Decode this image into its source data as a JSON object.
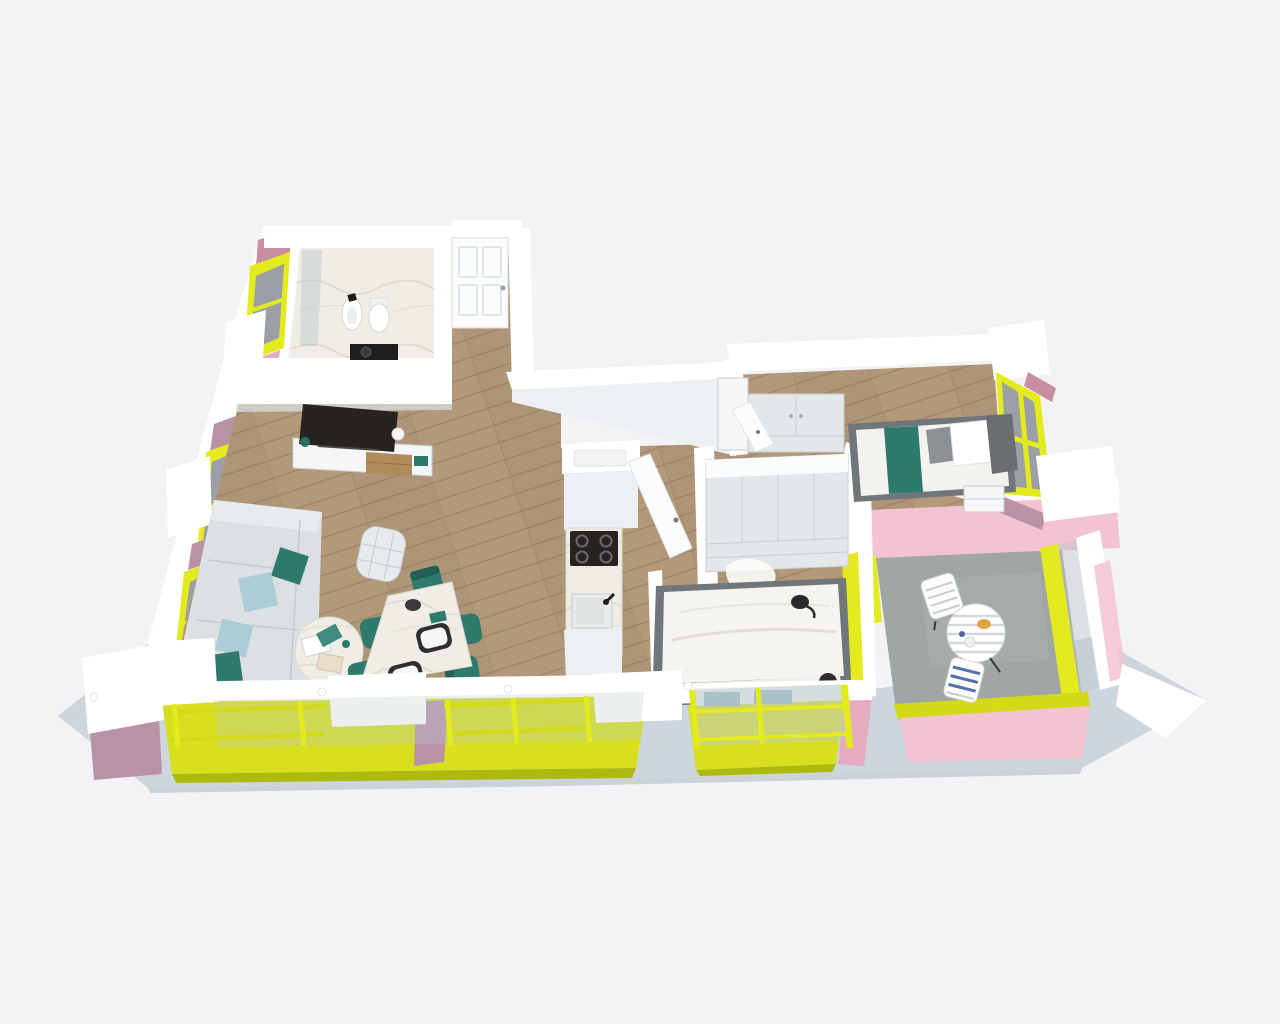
{
  "scene": {
    "type": "3d-floorplan-render",
    "view": "axonometric-top-down",
    "background": "#f3f3f5",
    "visible_text": ""
  },
  "palette": {
    "bg": "#f3f3f5",
    "wall_white": "#ffffff",
    "wall_face": "#edf0f2",
    "wall_shade": "#dde3e8",
    "wall_edge": "#d9dee2",
    "white_soft": "#fbfcfd",
    "slab": "#ccd6dc",
    "slab_dark": "#b9c5cc",
    "yellow": "#e3ea1d",
    "yellow_mid": "#d2da18",
    "yellow_dark": "#aeb90e",
    "yellow_floor": "#d7df1e",
    "pink": "#f3c3d2",
    "pink_mid": "#e5abbf",
    "mauve": "#b992a6",
    "pink_dusty": "#c98fa0",
    "glass": "#9aa0a5",
    "glass_light": "#bdc9ce",
    "wood": "#b3987a",
    "wood_line": "#a1866b",
    "wood_dark": "#8e795c",
    "marble": "#f0ede6",
    "marble_vein": "#d8d3c6",
    "concrete": "#a0a5a5",
    "sofa": "#dde0e2",
    "sofa_light": "#e8ebed",
    "sofa_line": "#c5cbcf",
    "teal": "#2e7b6e",
    "teal_dark": "#245f54",
    "light_blue": "#aacdd6",
    "blue_pillow": "#8fb2c2",
    "tv_black": "#272320",
    "black": "#1f1e1c",
    "furn_white": "#f4f6f7",
    "furn_gray": "#e4e7e9",
    "furn_line": "#c9ced2",
    "wood_furn": "#b18b5b",
    "frame_gray": "#71767a",
    "headboard": "#6a6e71",
    "rail_green": "#9fc58f"
  },
  "rooms": [
    {
      "id": "living-room",
      "floor": "wood",
      "furniture": [
        "corner-sofa",
        "teal-pillows",
        "light-blue-pillows",
        "round-coffee-table",
        "magazines",
        "swivel-armchair",
        "marble-dining-table",
        "teal-dining-chairs",
        "place-settings",
        "tv-sideboard",
        "tv"
      ]
    },
    {
      "id": "kitchen",
      "floor": "wood",
      "furniture": [
        "tall-cabinet",
        "black-cooktop",
        "marble-counter",
        "sink"
      ]
    },
    {
      "id": "entry-hall",
      "floor": "wood",
      "furniture": [
        "paneled-entry-door"
      ]
    },
    {
      "id": "bathroom",
      "floor": "marble",
      "furniture": [
        "bidet",
        "toilet",
        "black-vanity",
        "shower-glass"
      ]
    },
    {
      "id": "master-bedroom",
      "floor": "wood",
      "furniture": [
        "double-bed",
        "white-duvet",
        "blue-pillows",
        "wardrobe-4-door",
        "fur-rug",
        "cat",
        "open-door-leaf"
      ]
    },
    {
      "id": "kids-bedroom",
      "floor": "wood",
      "furniture": [
        "single-bed",
        "teal-runner",
        "white-pillow",
        "wardrobe-2-door",
        "nightstand",
        "open-door-leaf"
      ]
    },
    {
      "id": "terrace",
      "floor": "concrete",
      "furniture": [
        "round-bistro-table",
        "folding-chair",
        "folding-chair-blue-cushion",
        "snack-plate"
      ]
    },
    {
      "id": "balcony-living",
      "floor": "yellow",
      "furniture": []
    },
    {
      "id": "balcony-master",
      "floor": "yellow",
      "furniture": []
    }
  ],
  "exterior": {
    "window_frames": "yellow",
    "accent_walls": "pink-mauve",
    "balustrade": "white-handrail-over-glass",
    "base": "gray-concrete-slab"
  }
}
